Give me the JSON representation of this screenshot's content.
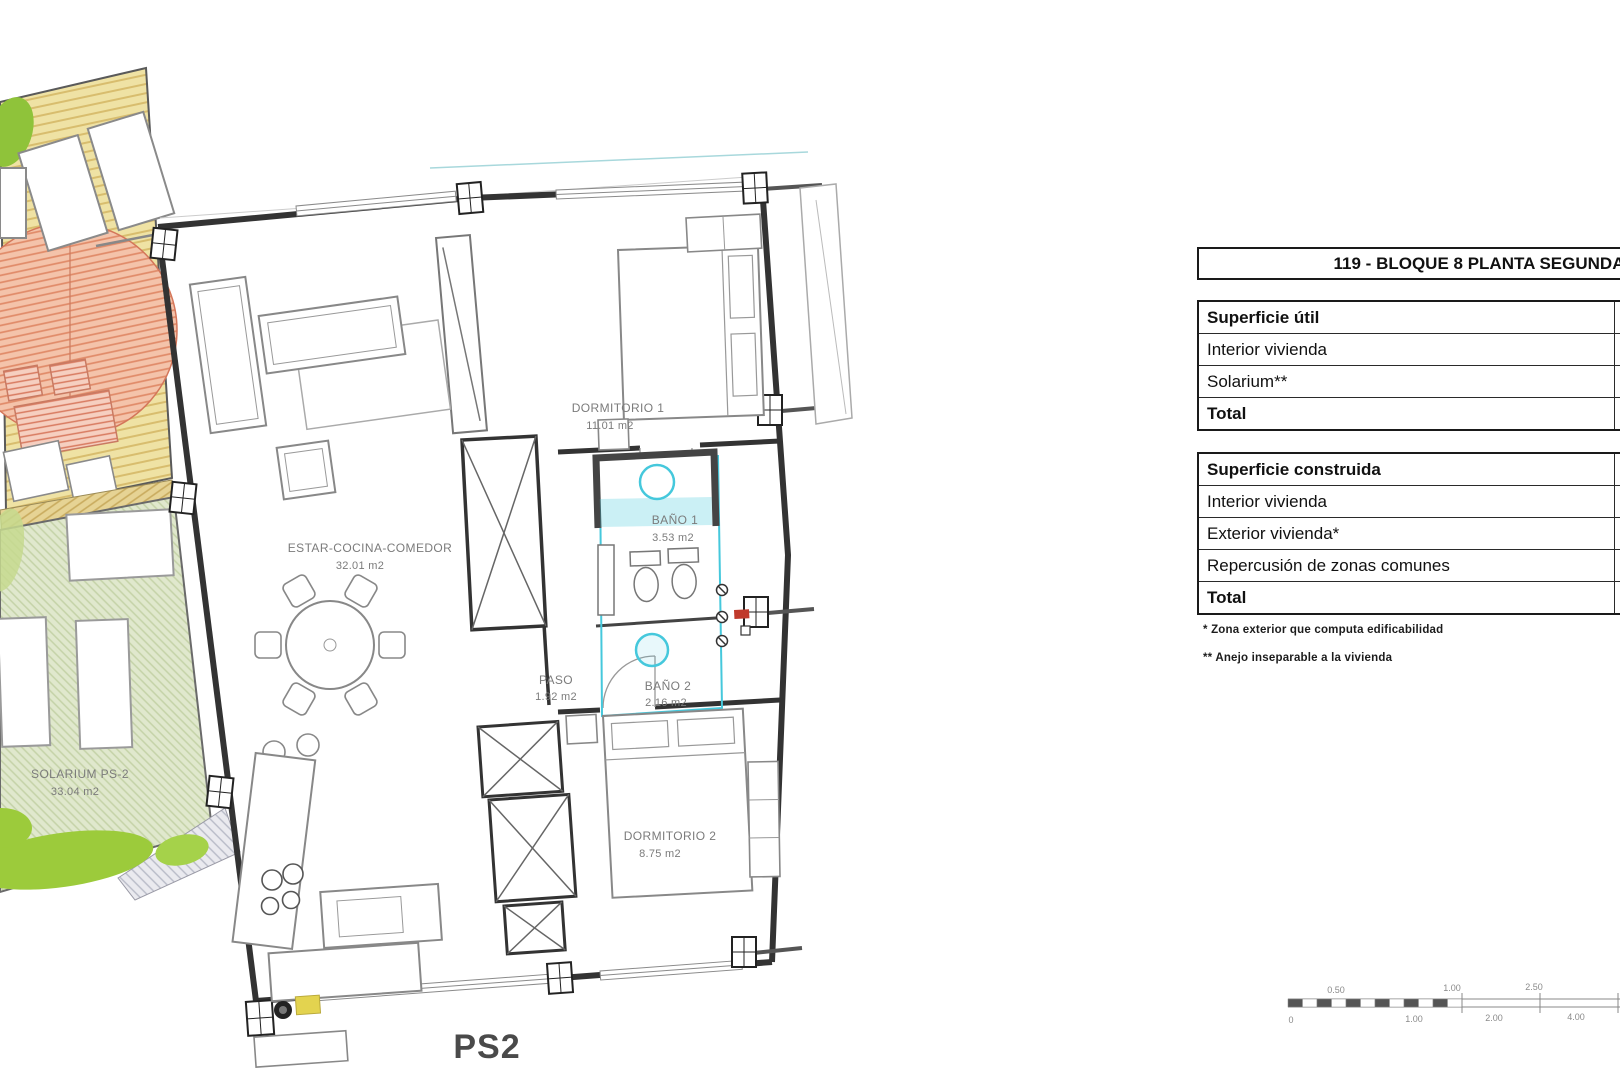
{
  "plan": {
    "sheet_label": "PS2",
    "rooms": [
      {
        "name": "ESTAR-COCINA-COMEDOR",
        "area": "32.01 m2"
      },
      {
        "name": "DORMITORIO 1",
        "area": "11.01 m2"
      },
      {
        "name": "BAÑO 1",
        "area": "3.53 m2"
      },
      {
        "name": "PASO",
        "area": "1.92 m2"
      },
      {
        "name": "BAÑO 2",
        "area": "2.16 m2"
      },
      {
        "name": "DORMITORIO 2",
        "area": "8.75 m2"
      },
      {
        "name": "SOLARIUM PS-2",
        "area": "33.04 m2"
      }
    ]
  },
  "panel": {
    "title": "119 - BLOQUE 8 PLANTA SEGUNDA",
    "superficie_util": {
      "header": "Superficie útil",
      "rows": [
        "Interior vivienda",
        "Solarium**"
      ],
      "total_label": "Total"
    },
    "superficie_construida": {
      "header": "Superficie construida",
      "rows": [
        "Interior vivienda",
        "Exterior vivienda*",
        "Repercusión de zonas comunes"
      ],
      "total_label": "Total"
    },
    "footnotes": [
      "* Zona exterior que computa edificabilidad",
      "** Anejo inseparable a la vivienda"
    ]
  },
  "scale_bar": {
    "top_labels": [
      "0.50",
      "1.00",
      "2.50"
    ],
    "bottom_labels": [
      "0",
      "1.00",
      "2.00",
      "4.00"
    ]
  },
  "colors": {
    "bath_highlight": "#45c8dc",
    "deck_hatch": "#e8d694",
    "lawn_hatch": "#dde7c9",
    "awning_hatch": "#eda184",
    "plant_green": "#9ccb3b"
  }
}
